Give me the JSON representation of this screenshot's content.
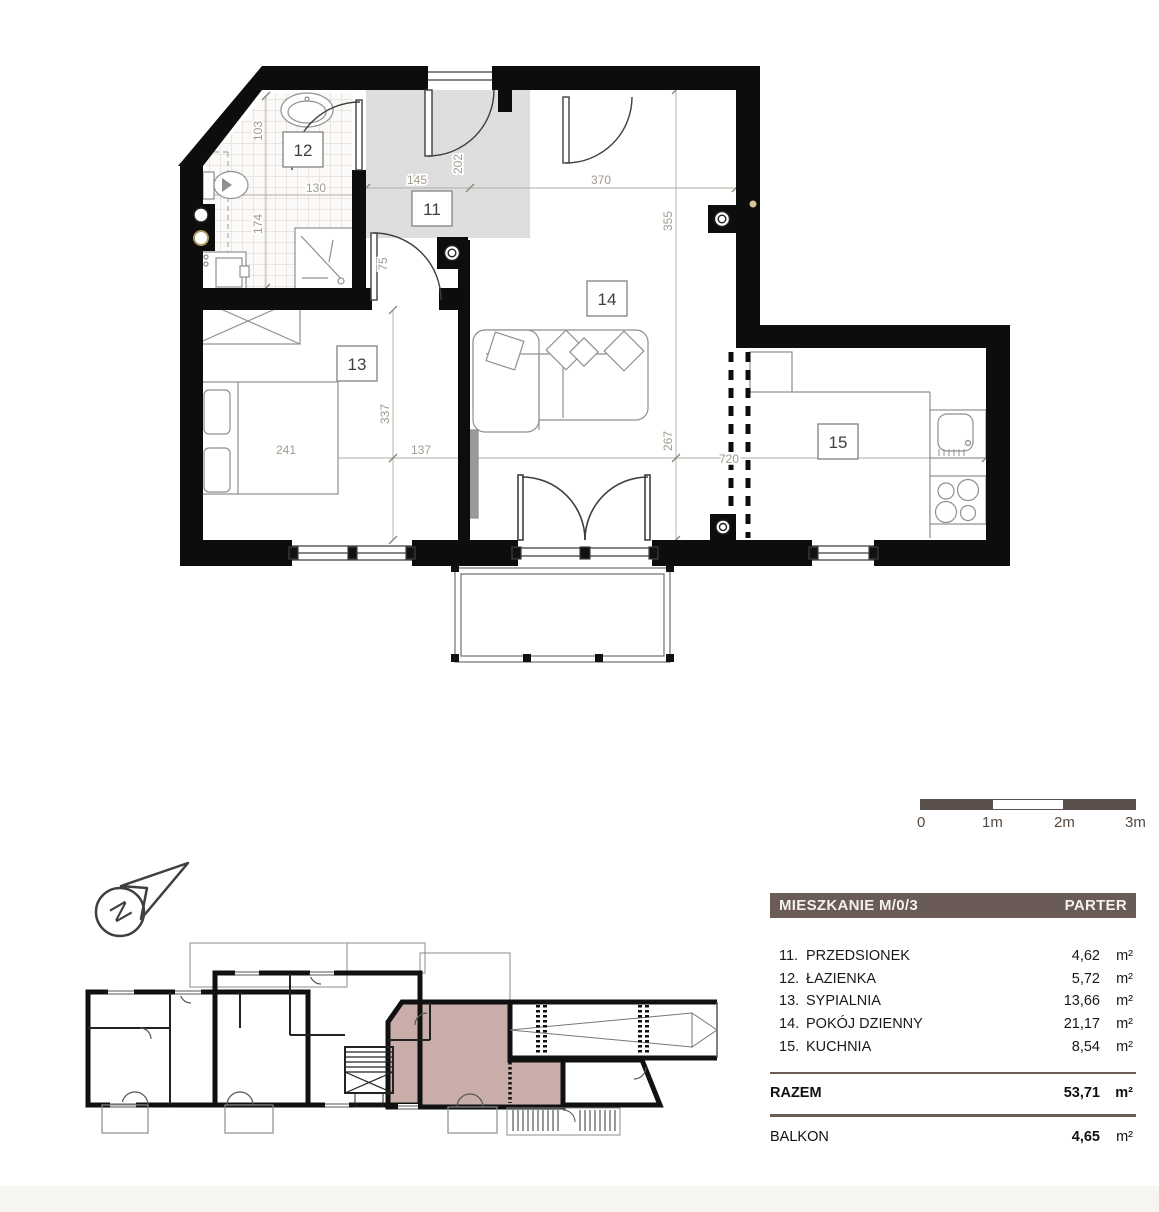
{
  "plan": {
    "room_labels": {
      "r11": "11",
      "r12": "12",
      "r13": "13",
      "r14": "14",
      "r15": "15"
    },
    "dimensions": {
      "d103": "103",
      "d130": "130",
      "d174": "174",
      "d145": "145",
      "d202": "202",
      "d370": "370",
      "d355": "355",
      "d75": "75",
      "d241": "241",
      "d337": "337",
      "d137": "137",
      "d267": "267",
      "d720": "720"
    }
  },
  "scale_bar": {
    "tick0": "0",
    "tick1": "1m",
    "tick2": "2m",
    "tick3": "3m"
  },
  "compass": {
    "label": "N"
  },
  "legend": {
    "title": "MIESZKANIE M/0/3",
    "floor_label": "PARTER",
    "rooms": [
      {
        "no": "11.",
        "name": "PRZEDSIONEK",
        "area": "4,62",
        "unit": "m²"
      },
      {
        "no": "12.",
        "name": "ŁAZIENKA",
        "area": "5,72",
        "unit": "m²"
      },
      {
        "no": "13.",
        "name": "SYPIALNIA",
        "area": "13,66",
        "unit": "m²"
      },
      {
        "no": "14.",
        "name": "POKÓJ DZIENNY",
        "area": "21,17",
        "unit": "m²"
      },
      {
        "no": "15.",
        "name": "KUCHNIA",
        "area": "8,54",
        "unit": "m²"
      }
    ],
    "total_label": "RAZEM",
    "total_area": "53,71",
    "total_unit": "m²",
    "balcony_label": "BALKON",
    "balcony_area": "4,65",
    "balcony_unit": "m²"
  },
  "colors": {
    "accent_brown": "#6b5b57",
    "highlight_rose": "#c9ada8",
    "wall_black": "#0d0d0d",
    "hall_gray": "#dedede",
    "scale_dark": "#5c504d"
  }
}
